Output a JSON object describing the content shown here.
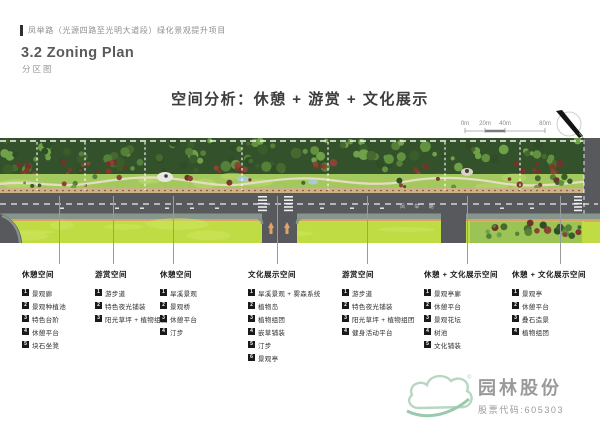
{
  "header": {
    "project_title": "凤举路（光源四路至光明大道段）绿化景观提升项目",
    "section_title": "3.2 Zoning Plan",
    "section_subtitle": "分区图"
  },
  "main_title": "空间分析：休憩 + 游赏 + 文化展示",
  "scale_bar": {
    "labels": [
      "0m",
      "20m",
      "40m",
      "80m"
    ]
  },
  "north_arrow": {
    "label": "N"
  },
  "plan": {
    "road_name": "凤 举 路"
  },
  "zones": [
    {
      "title": "休憩空间",
      "items": [
        "景观廊",
        "景观种植池",
        "特色台阶",
        "休憩平台",
        "块石坐凳"
      ]
    },
    {
      "title": "游赏空间",
      "items": [
        "游步道",
        "特色夜光铺装",
        "阳光草坪 + 植物组团"
      ]
    },
    {
      "title": "休憩空间",
      "items": [
        "旱溪景观",
        "景观桥",
        "休憩平台",
        "汀步"
      ]
    },
    {
      "title": "文化展示空间",
      "items": [
        "旱溪景观 + 雾森系统",
        "植物岛",
        "植物组团",
        "嵌草铺装",
        "汀步",
        "景观亭"
      ]
    },
    {
      "title": "游赏空间",
      "items": [
        "游步道",
        "特色夜光铺装",
        "阳光草坪 + 植物组团",
        "健身活动平台"
      ]
    },
    {
      "title": "休憩 + 文化展示空间",
      "items": [
        "景观亭廊",
        "休憩平台",
        "景观花坛",
        "树池",
        "文化铺装"
      ]
    },
    {
      "title": "休憩 + 文化展示空间",
      "items": [
        "景观亭",
        "休憩平台",
        "叠石造景",
        "植物组团"
      ]
    }
  ],
  "logo": {
    "company": "园林股份",
    "stock_code": "股票代码:605303",
    "registered": "®"
  },
  "colors": {
    "accent_green": "#a9cdb8",
    "lawn_bright": "#c0dc45",
    "road_grey": "#57595d",
    "text_grey": "#8f8f8f"
  }
}
